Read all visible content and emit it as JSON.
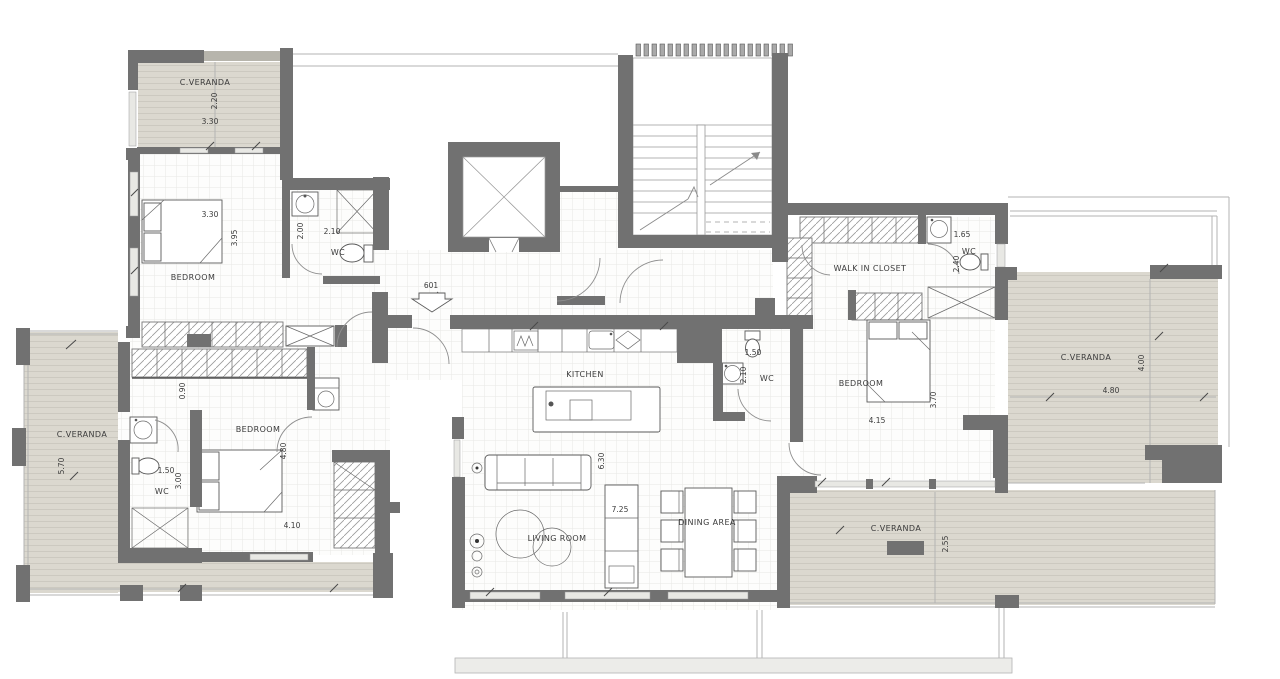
{
  "unit": {
    "number": "601"
  },
  "rooms": {
    "veranda_top_left": {
      "label": "C.VERANDA",
      "width": "3.30",
      "depth": "2.20"
    },
    "bedroom_top_left": {
      "label": "BEDROOM",
      "width": "3.30",
      "depth": "3.95"
    },
    "wc_top": {
      "label": "WC",
      "width": "2.10",
      "depth": "2.00"
    },
    "walk_in_closet": {
      "label": "WALK IN CLOSET"
    },
    "wc_top_right": {
      "label": "WC",
      "width": "1.65",
      "depth": "2.40"
    },
    "bedroom_right": {
      "label": "BEDROOM",
      "width": "4.15",
      "depth": "3.70"
    },
    "veranda_right": {
      "label": "C.VERANDA",
      "width": "4.80",
      "depth": "4.00"
    },
    "veranda_left": {
      "label": "C.VERANDA",
      "depth": "5.70"
    },
    "corridor": {
      "width": "0.90"
    },
    "wc_left": {
      "label": "WC",
      "width": "1.50",
      "depth": "3.00"
    },
    "bedroom_bottom_left": {
      "label": "BEDROOM",
      "width": "4.10",
      "depth": "4.80"
    },
    "kitchen": {
      "label": "KITCHEN"
    },
    "wc_kitchen": {
      "label": "WC",
      "width": "1.50",
      "depth": "2.10"
    },
    "living_room": {
      "label": "LIVING ROOM",
      "width": "7.25",
      "depth": "6.30"
    },
    "dining_area": {
      "label": "DINING AREA"
    },
    "veranda_bottom": {
      "label": "C.VERANDA",
      "depth": "2.55"
    }
  },
  "colors": {
    "wall": "#717171",
    "veranda_fill": "#dbd8cf",
    "tile_line": "#e8e8e5",
    "hatch_line": "#9a9a9a",
    "text": "#3b3b3b"
  }
}
